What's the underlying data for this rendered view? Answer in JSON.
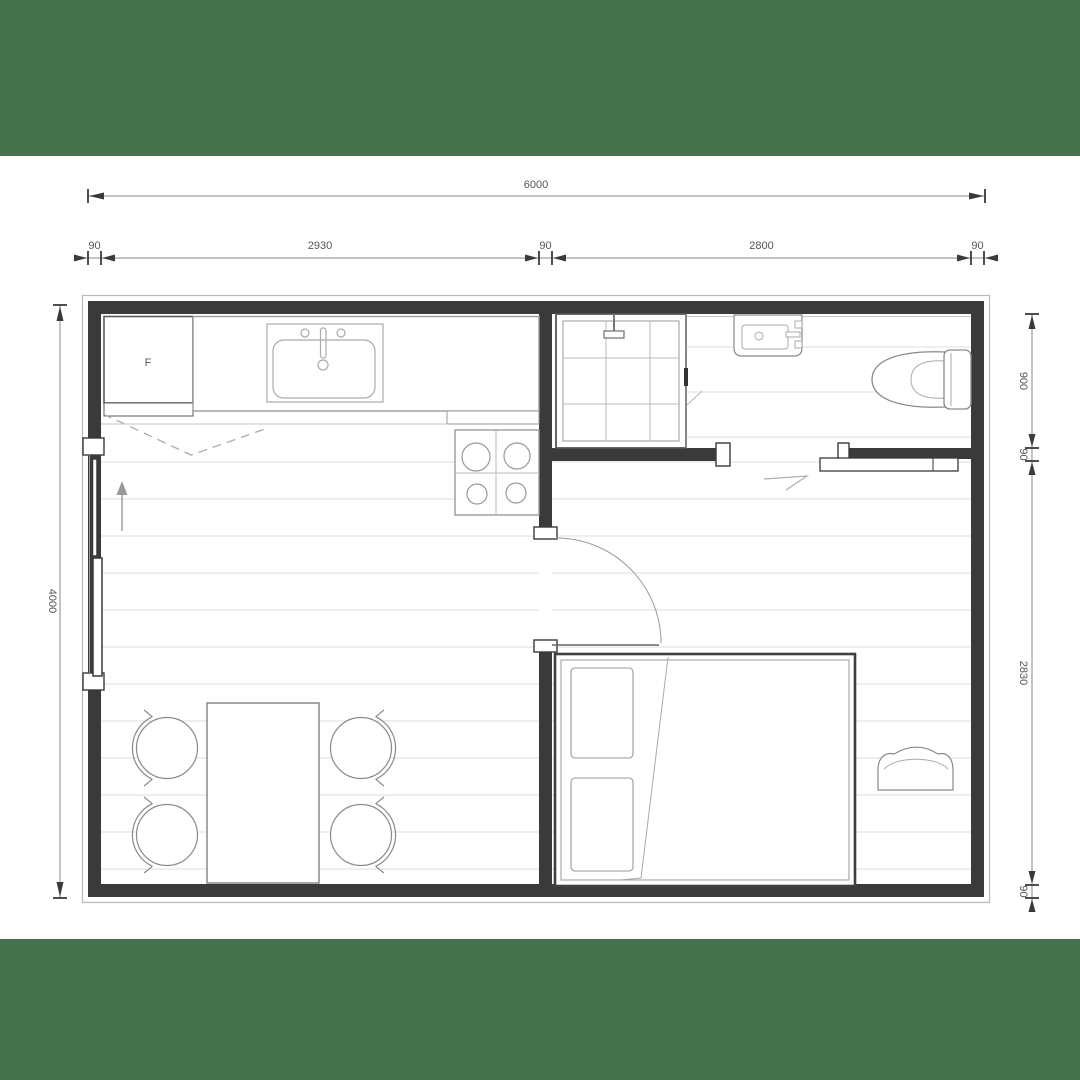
{
  "page": {
    "background_color": "#47724e",
    "paper_color": "#ffffff"
  },
  "floor_plan": {
    "fridge_label": "F",
    "dimensions": {
      "total_width": "6000",
      "top_row": [
        "90",
        "2930",
        "90",
        "2800",
        "90"
      ],
      "total_height": "4000",
      "right_col": [
        "900",
        "90",
        "2830",
        "90"
      ]
    }
  }
}
